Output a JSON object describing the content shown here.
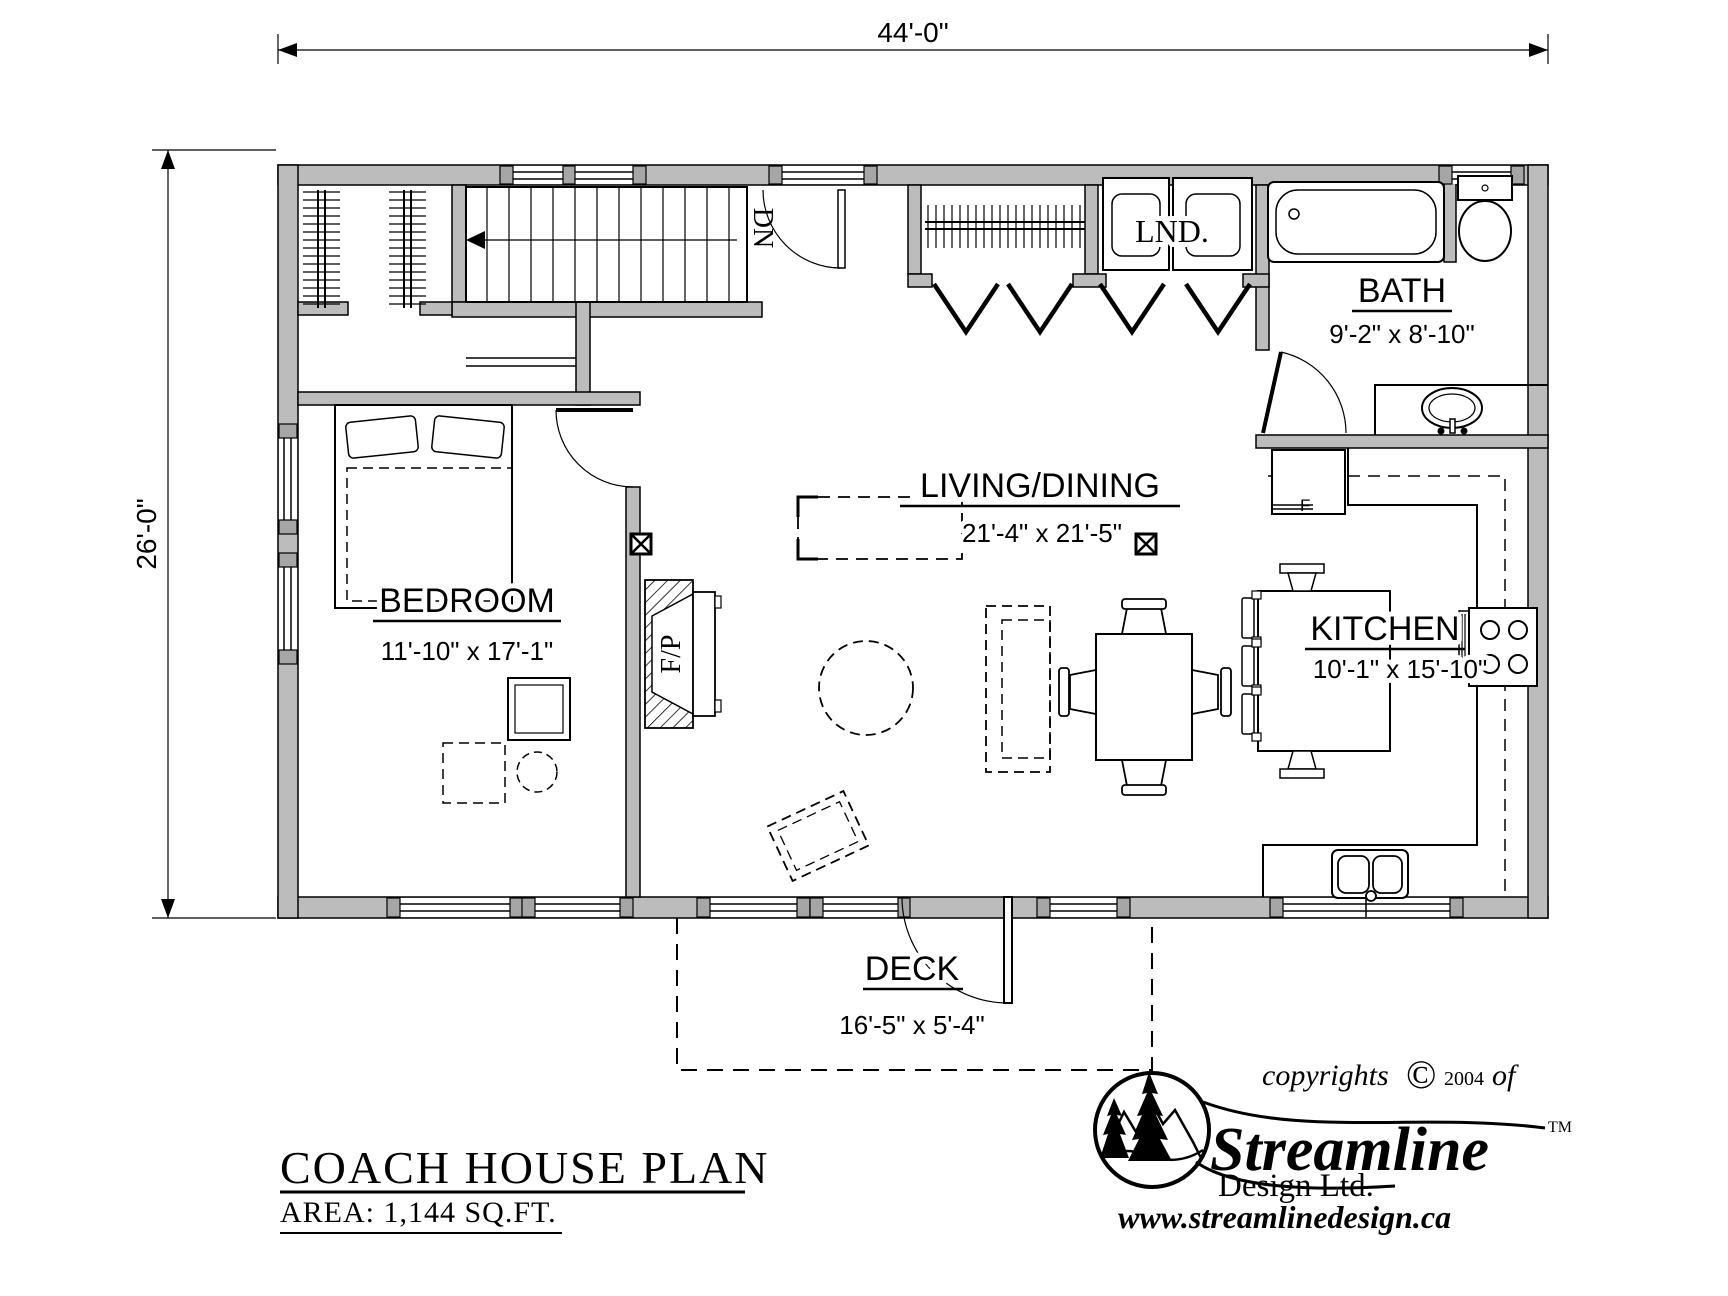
{
  "dims": {
    "overall_width": "44'-0\"",
    "overall_height": "26'-0\""
  },
  "rooms": {
    "bedroom": {
      "name": "BEDROOM",
      "size": "11'-10\" x 17'-1\""
    },
    "living_dining": {
      "name": "LIVING/DINING",
      "size": "21'-4\" x 21'-5\""
    },
    "kitchen": {
      "name": "KITCHEN",
      "size": "10'-1\" x 15'-10\""
    },
    "bath": {
      "name": "BATH",
      "size": "9'-2\" x 8'-10\""
    },
    "laundry": {
      "name": "LND."
    },
    "deck": {
      "name": "DECK",
      "size": "16'-5\" x 5'-4\""
    }
  },
  "annotations": {
    "stairs_direction": "DN",
    "fireplace": "F/P",
    "fridge": "F"
  },
  "title_block": {
    "title": "COACH HOUSE PLAN",
    "area": "AREA: 1,144 SQ.FT."
  },
  "branding": {
    "copyright_prefix": "copyrights",
    "copyright_symbol": "©",
    "copyright_year": "2004",
    "copyright_suffix": "of",
    "company": "Streamline",
    "trademark": "TM",
    "company_line2": "Design Ltd.",
    "website": "www.streamlinedesign.ca"
  },
  "colors": {
    "wall_fill": "#bcbcbc",
    "post_fill": "#a6a6a6",
    "line": "#000000",
    "background": "#ffffff"
  }
}
